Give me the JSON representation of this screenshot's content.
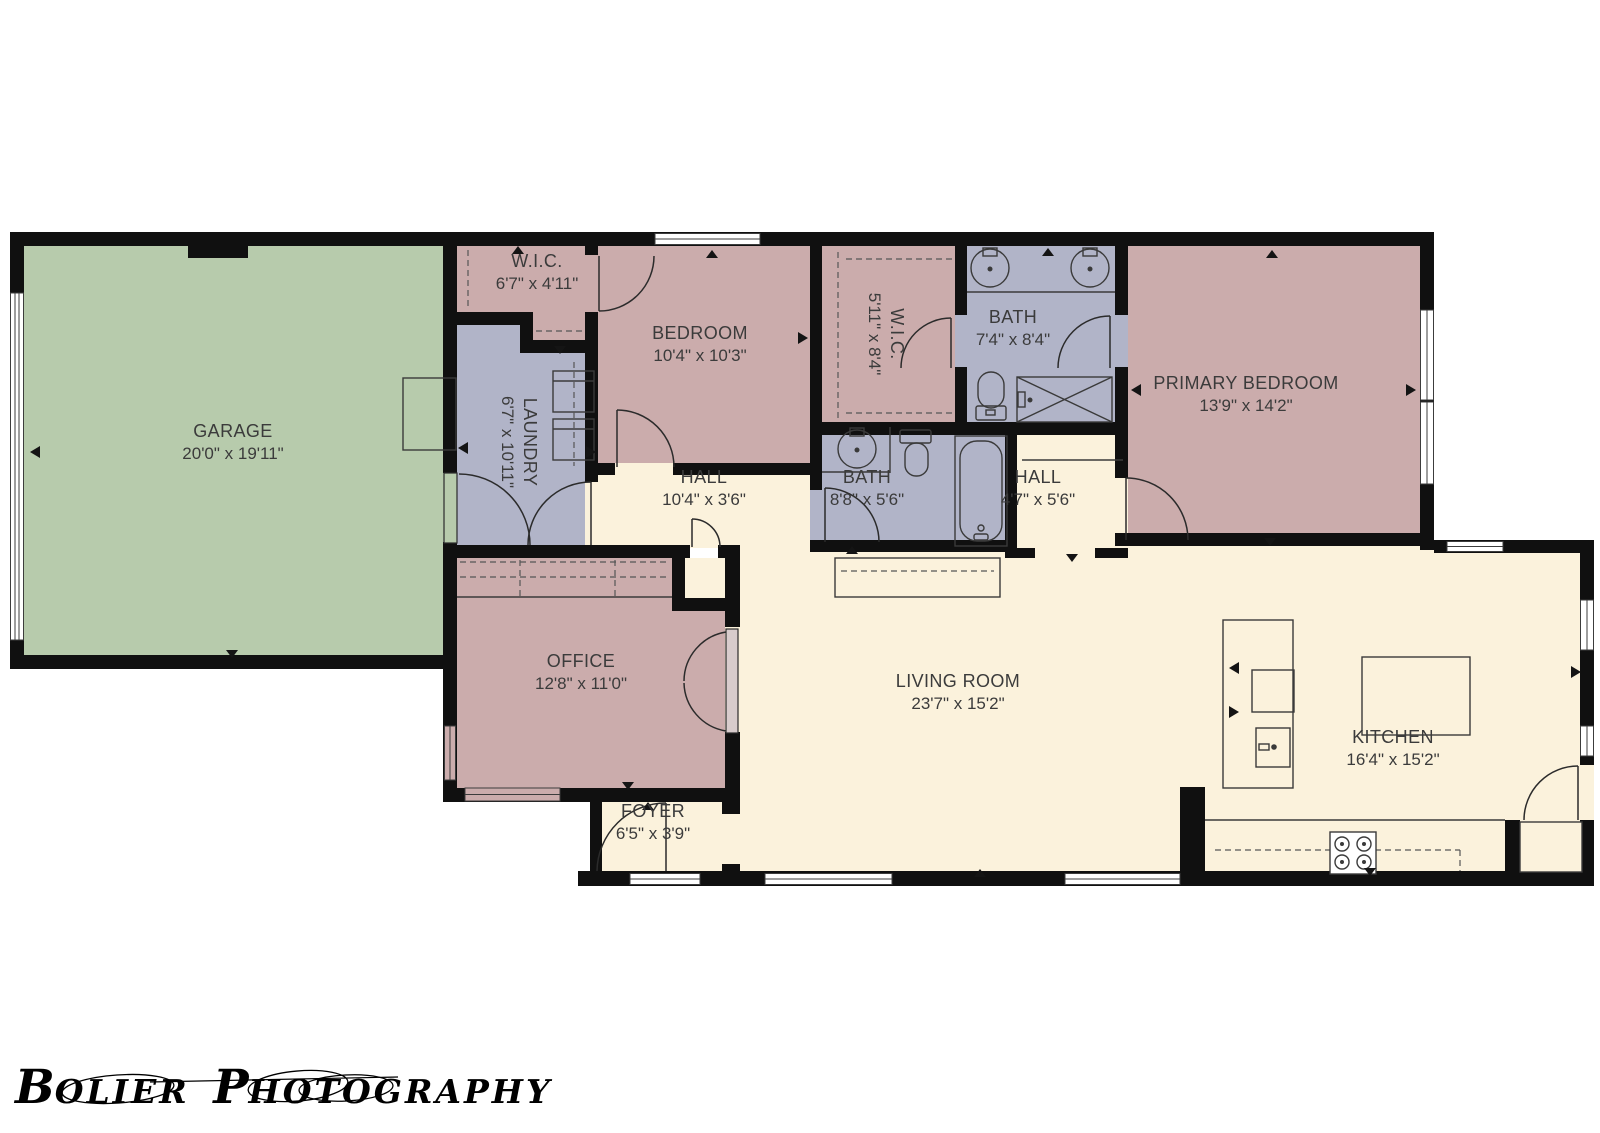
{
  "colors": {
    "wall": "#101010",
    "garage": "#b7cbac",
    "bedroom_pink": "#cbacac",
    "bath_blue": "#b1b4c8",
    "floor_cream": "#fbf2dc",
    "label_text": "#3b3b3b",
    "background": "#ffffff"
  },
  "watermark": {
    "text": "BOLIER PHOTOGRAPHY"
  },
  "rooms": {
    "garage": {
      "name": "GARAGE",
      "dims": "20'0\" x 19'11\""
    },
    "wic1": {
      "name": "W.I.C.",
      "dims": "6'7\" x 4'11\""
    },
    "bedroom": {
      "name": "BEDROOM",
      "dims": "10'4\" x 10'3\""
    },
    "wic2": {
      "name": "W.I.C.",
      "dims": "5'11\" x 8'4\""
    },
    "bath1": {
      "name": "BATH",
      "dims": "7'4\" x 8'4\""
    },
    "primary": {
      "name": "PRIMARY BEDROOM",
      "dims": "13'9\" x 14'2\""
    },
    "laundry": {
      "name": "LAUNDRY",
      "dims": "6'7\" x 10'11\""
    },
    "hall1": {
      "name": "HALL",
      "dims": "10'4\" x 3'6\""
    },
    "bath2": {
      "name": "BATH",
      "dims": "8'8\" x 5'6\""
    },
    "hall2": {
      "name": "HALL",
      "dims": "4'7\" x 5'6\""
    },
    "office": {
      "name": "OFFICE",
      "dims": "12'8\" x 11'0\""
    },
    "living": {
      "name": "LIVING ROOM",
      "dims": "23'7\" x 15'2\""
    },
    "kitchen": {
      "name": "KITCHEN",
      "dims": "16'4\" x 15'2\""
    },
    "foyer": {
      "name": "FOYER",
      "dims": "6'5\" x 3'9\""
    }
  }
}
